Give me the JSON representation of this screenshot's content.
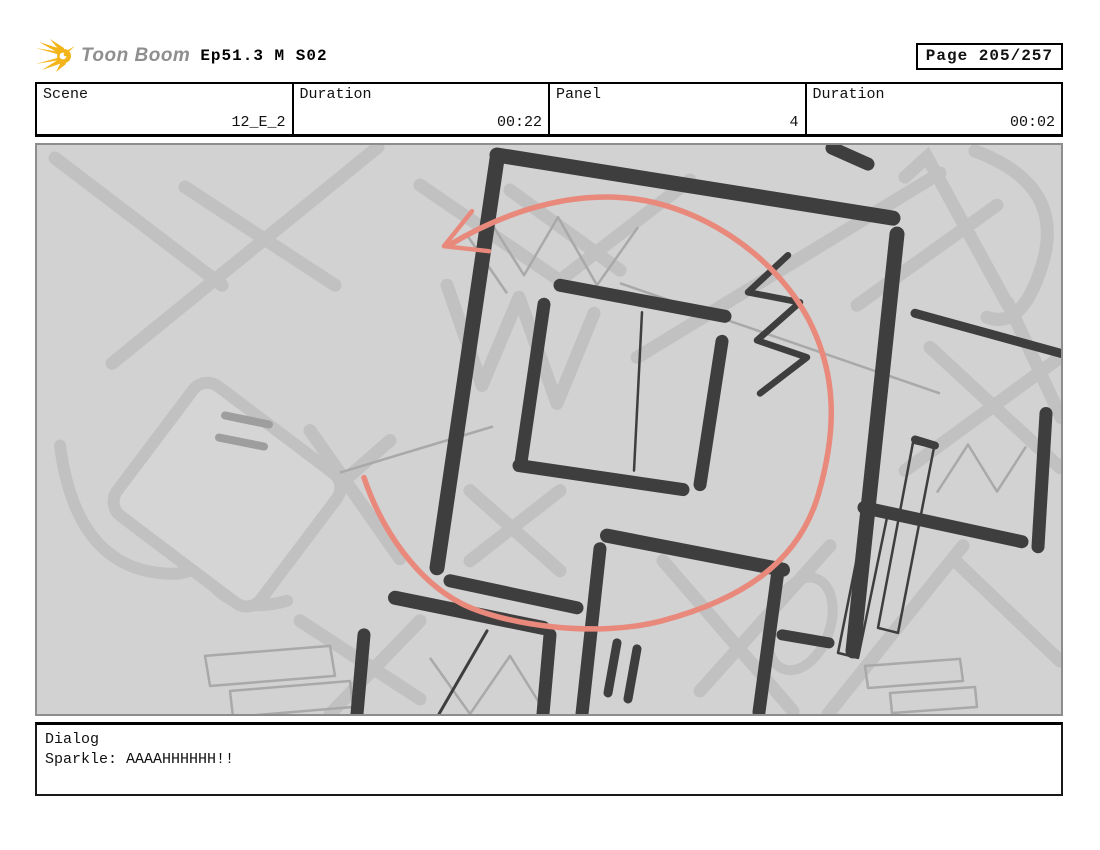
{
  "header": {
    "brand": "Toon Boom",
    "title": "Ep51.3 M S02",
    "page_label": "Page 205/257"
  },
  "info_table": {
    "cells": [
      {
        "label": "Scene",
        "value": "12_E_2"
      },
      {
        "label": "Duration",
        "value": "00:22"
      },
      {
        "label": "Panel",
        "value": "4"
      },
      {
        "label": "Duration",
        "value": "00:02"
      }
    ]
  },
  "panel": {
    "colors": {
      "canvas": "#d2d2d2",
      "ink": "#3e3e3e",
      "pencil": "#c1c1c1",
      "pencil_dark": "#a9a9a9",
      "accent": "#e8897c"
    }
  },
  "dialog": {
    "label": "Dialog",
    "text": "Sparkle: AAAAHHHHHH!!"
  }
}
